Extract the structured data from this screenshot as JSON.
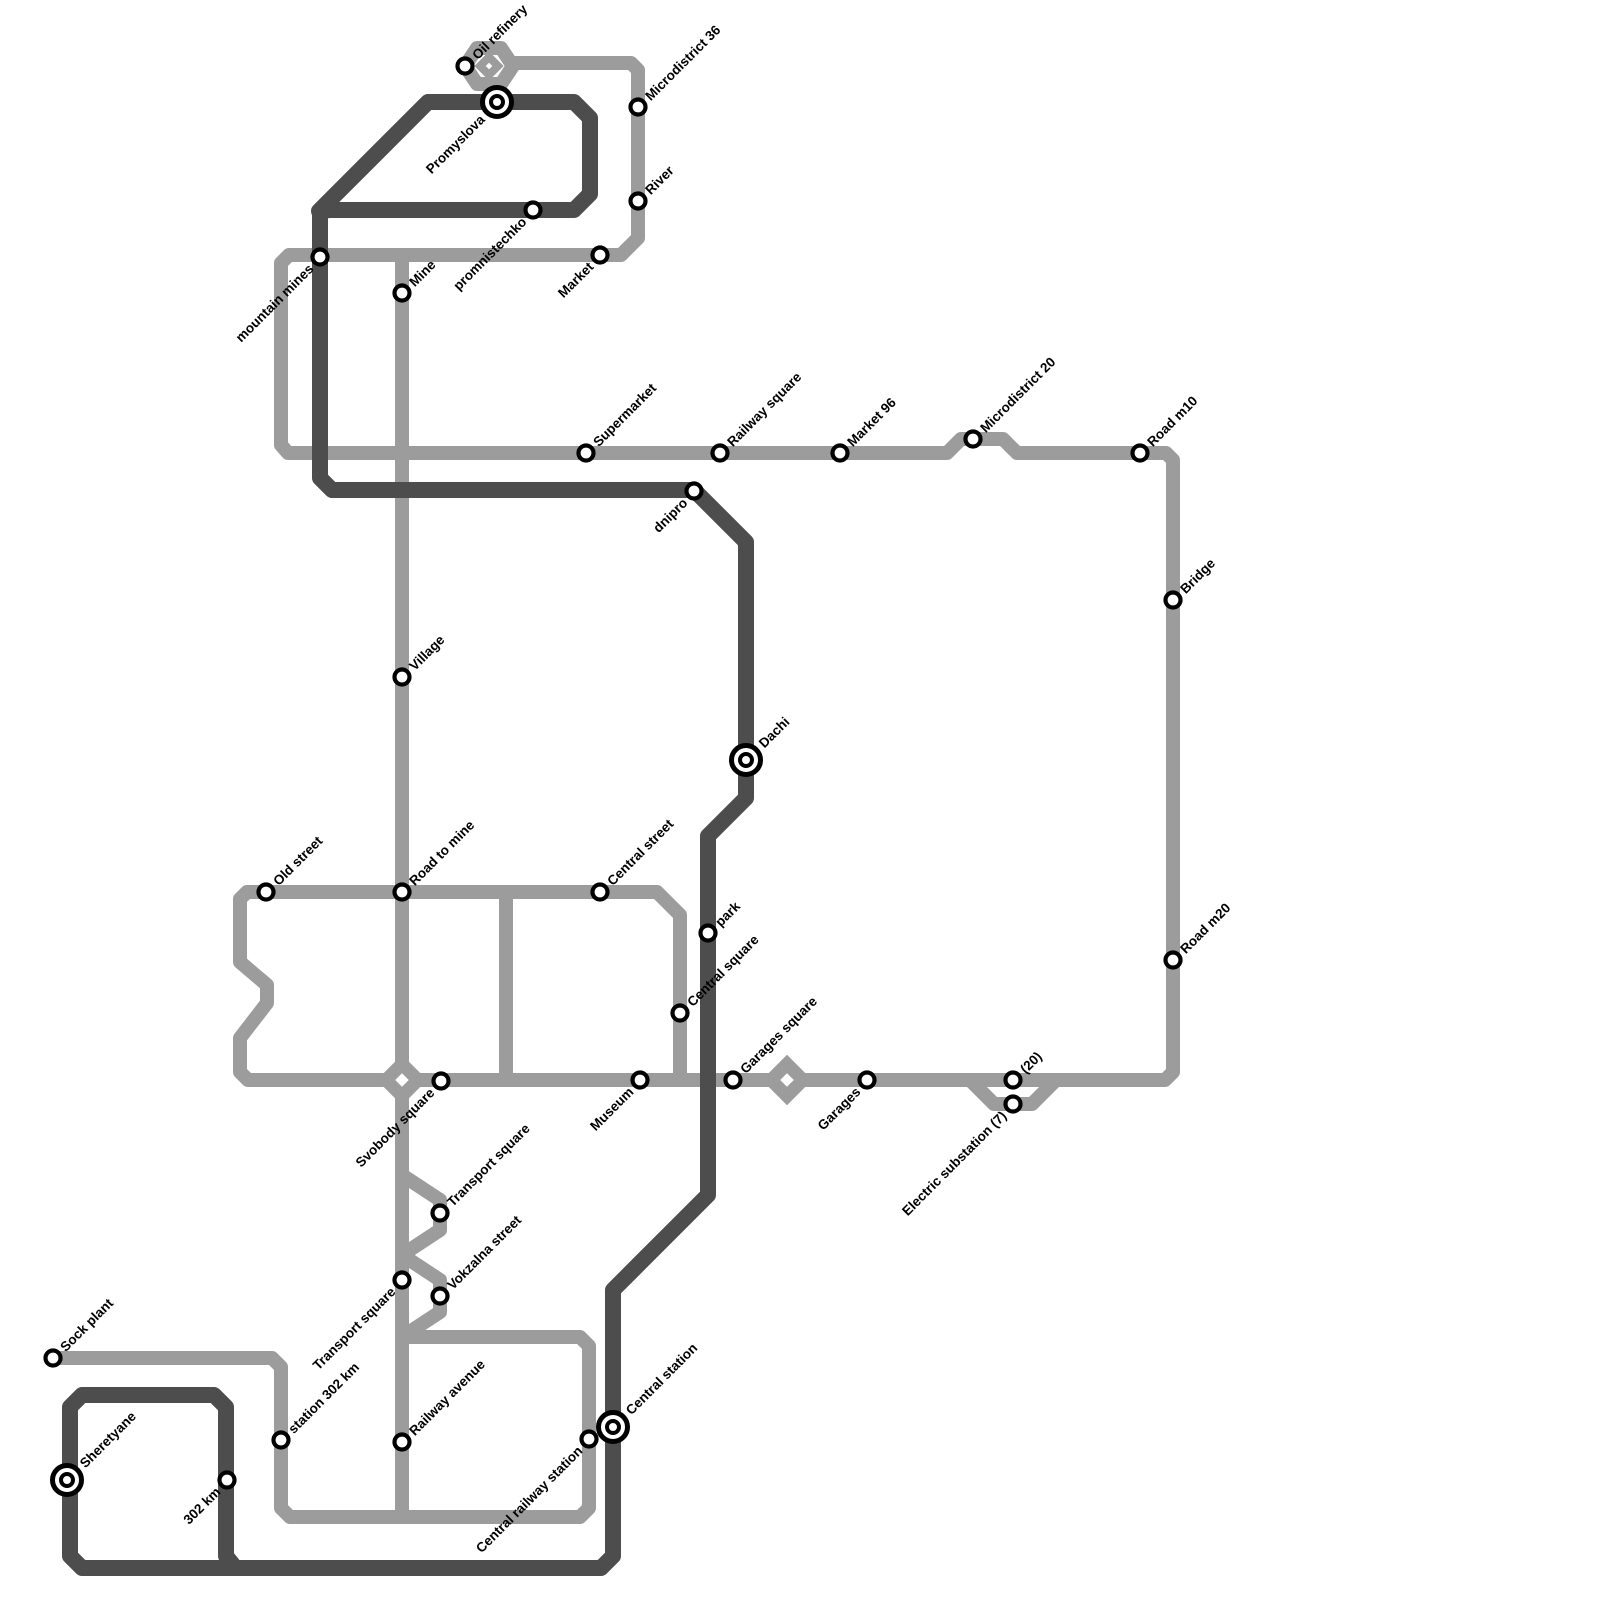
{
  "map": {
    "background": "#ffffff",
    "line_colors": {
      "light": "#9c9c9c",
      "dark": "#4d4d4d"
    },
    "routes": [
      {
        "id": "light-route",
        "color": "#9c9c9c",
        "width": 14,
        "paths": [
          {
            "closed": false,
            "points": [
              [
                515,
                63
              ],
              [
                631,
                63
              ],
              [
                638,
                70
              ],
              [
                638,
                238
              ],
              [
                621,
                255
              ],
              [
                289,
                255
              ],
              [
                281,
                263
              ],
              [
                281,
                445
              ],
              [
                288,
                453
              ],
              [
                947,
                453
              ],
              [
                961,
                439
              ],
              [
                1003,
                439
              ],
              [
                1017,
                453
              ],
              [
                1166,
                453
              ],
              [
                1173,
                460
              ],
              [
                1173,
                1072
              ],
              [
                1165,
                1080
              ],
              [
                248,
                1080
              ],
              [
                240,
                1072
              ],
              [
                240,
                1038
              ],
              [
                267,
                1003
              ],
              [
                267,
                985
              ],
              [
                240,
                962
              ],
              [
                240,
                899
              ],
              [
                247,
                892
              ],
              [
                657,
                892
              ],
              [
                680,
                915
              ],
              [
                680,
                1080
              ]
            ]
          },
          {
            "closed": false,
            "points": [
              [
                506,
                892
              ],
              [
                506,
                1080
              ]
            ]
          },
          {
            "closed": false,
            "points": [
              [
                402,
                255
              ],
              [
                402,
                1337
              ]
            ]
          },
          {
            "closed": false,
            "points": [
              [
                402,
                1175
              ],
              [
                440,
                1200
              ],
              [
                440,
                1230
              ],
              [
                402,
                1255
              ]
            ]
          },
          {
            "closed": false,
            "points": [
              [
                402,
                1255
              ],
              [
                440,
                1280
              ],
              [
                440,
                1312
              ],
              [
                402,
                1337
              ]
            ]
          },
          {
            "closed": false,
            "points": [
              [
                970,
                1080
              ],
              [
                994,
                1104
              ],
              [
                1032,
                1104
              ],
              [
                1056,
                1080
              ]
            ]
          },
          {
            "closed": false,
            "points": [
              [
                53,
                1358
              ],
              [
                272,
                1358
              ],
              [
                281,
                1367
              ],
              [
                281,
                1508
              ],
              [
                290,
                1517
              ],
              [
                402,
                1517
              ]
            ]
          },
          {
            "closed": true,
            "points": [
              [
                402,
                1517
              ],
              [
                402,
                1337
              ],
              [
                410,
                1337
              ],
              [
                580,
                1337
              ],
              [
                589,
                1346
              ],
              [
                589,
                1508
              ],
              [
                580,
                1517
              ]
            ]
          },
          {
            "closed": true,
            "points": [
              [
                465,
                66
              ],
              [
                477,
                48
              ],
              [
                501,
                48
              ],
              [
                513,
                66
              ],
              [
                501,
                84
              ],
              [
                477,
                84
              ]
            ]
          }
        ]
      },
      {
        "id": "dark-route",
        "color": "#4d4d4d",
        "width": 16,
        "paths": [
          {
            "closed": true,
            "points": [
              [
                319,
                211
              ],
              [
                428,
                102
              ],
              [
                574,
                102
              ],
              [
                590,
                118
              ],
              [
                590,
                194
              ],
              [
                574,
                210
              ],
              [
                330,
                210
              ]
            ]
          },
          {
            "closed": false,
            "points": [
              [
                320,
                212
              ],
              [
                320,
                478
              ],
              [
                332,
                490
              ],
              [
                694,
                490
              ],
              [
                746,
                542
              ],
              [
                746,
                798
              ],
              [
                708,
                836
              ],
              [
                708,
                1195
              ],
              [
                613,
                1290
              ],
              [
                613,
                1556
              ],
              [
                601,
                1568
              ],
              [
                82,
                1568
              ],
              [
                70,
                1556
              ],
              [
                70,
                1407
              ],
              [
                82,
                1395
              ],
              [
                214,
                1395
              ],
              [
                226,
                1407
              ],
              [
                226,
                1556
              ],
              [
                234,
                1566
              ]
            ]
          }
        ]
      }
    ],
    "depot_diamonds": [
      {
        "name": "oil-refinery-depot",
        "x": 489,
        "y": 66,
        "r": 9,
        "stroke": 8,
        "route": "light"
      },
      {
        "name": "svobody-square-depot",
        "x": 402,
        "y": 1080,
        "r": 16,
        "stroke": 13,
        "route": "light"
      },
      {
        "name": "garages-square-depot",
        "x": 787,
        "y": 1080,
        "r": 16,
        "stroke": 13,
        "route": "light"
      }
    ],
    "stations": [
      {
        "name": "Oil refinery",
        "x": 465,
        "y": 66,
        "kind": "regular",
        "label_dir": "ne",
        "route": "light"
      },
      {
        "name": "Microdistrict 36",
        "x": 638,
        "y": 107,
        "kind": "regular",
        "label_dir": "ne",
        "route": "light"
      },
      {
        "name": "River",
        "x": 638,
        "y": 201,
        "kind": "regular",
        "label_dir": "ne",
        "route": "light"
      },
      {
        "name": "Market",
        "x": 600,
        "y": 255,
        "kind": "regular",
        "label_dir": "sw",
        "route": "light"
      },
      {
        "name": "mountain mines",
        "x": 320,
        "y": 257,
        "kind": "regular",
        "label_dir": "sw",
        "route": "light"
      },
      {
        "name": "Mine",
        "x": 402,
        "y": 293,
        "kind": "regular",
        "label_dir": "ne",
        "route": "light"
      },
      {
        "name": "Village",
        "x": 402,
        "y": 677,
        "kind": "regular",
        "label_dir": "ne",
        "route": "light"
      },
      {
        "name": "Supermarket",
        "x": 586,
        "y": 453,
        "kind": "regular",
        "label_dir": "ne",
        "route": "light"
      },
      {
        "name": "Railway square",
        "x": 720,
        "y": 453,
        "kind": "regular",
        "label_dir": "ne",
        "route": "light"
      },
      {
        "name": "Market 96",
        "x": 840,
        "y": 453,
        "kind": "regular",
        "label_dir": "ne",
        "route": "light"
      },
      {
        "name": "Microdistrict 20",
        "x": 973,
        "y": 439,
        "kind": "regular",
        "label_dir": "ne",
        "route": "light"
      },
      {
        "name": "Road m10",
        "x": 1140,
        "y": 453,
        "kind": "regular",
        "label_dir": "ne",
        "route": "light"
      },
      {
        "name": "Bridge",
        "x": 1173,
        "y": 600,
        "kind": "regular",
        "label_dir": "ne",
        "route": "light"
      },
      {
        "name": "Road m20",
        "x": 1173,
        "y": 960,
        "kind": "regular",
        "label_dir": "ne",
        "route": "light"
      },
      {
        "name": "Old street",
        "x": 266,
        "y": 892,
        "kind": "regular",
        "label_dir": "ne",
        "route": "light"
      },
      {
        "name": "Road to mine",
        "x": 402,
        "y": 892,
        "kind": "regular",
        "label_dir": "ne",
        "route": "light"
      },
      {
        "name": "Central street",
        "x": 600,
        "y": 892,
        "kind": "regular",
        "label_dir": "ne",
        "route": "light"
      },
      {
        "name": "Central square",
        "x": 680,
        "y": 1013,
        "kind": "regular",
        "label_dir": "ne",
        "route": "light"
      },
      {
        "name": "Svobody square",
        "x": 441,
        "y": 1081,
        "kind": "regular",
        "label_dir": "sw",
        "route": "light"
      },
      {
        "name": "Museum",
        "x": 640,
        "y": 1080,
        "kind": "regular",
        "label_dir": "sw",
        "route": "light"
      },
      {
        "name": "Garages square",
        "x": 733,
        "y": 1080,
        "kind": "regular",
        "label_dir": "ne",
        "route": "light"
      },
      {
        "name": "Garages",
        "x": 867,
        "y": 1080,
        "kind": "regular",
        "label_dir": "sw",
        "route": "light"
      },
      {
        "name": "(20)",
        "x": 1013,
        "y": 1080,
        "kind": "regular",
        "label_dir": "ne",
        "route": "light"
      },
      {
        "name": "Electric substation (7)",
        "x": 1013,
        "y": 1104,
        "kind": "regular",
        "label_dir": "sw",
        "route": "light"
      },
      {
        "name": "Transport square",
        "x": 440,
        "y": 1213,
        "kind": "regular",
        "label_dir": "ne",
        "route": "light"
      },
      {
        "name": "Transport square",
        "x": 402,
        "y": 1280,
        "kind": "regular",
        "label_dir": "sw",
        "route": "light"
      },
      {
        "name": "Vokzalna street",
        "x": 440,
        "y": 1296,
        "kind": "regular",
        "label_dir": "ne",
        "route": "light"
      },
      {
        "name": "Railway avenue",
        "x": 402,
        "y": 1442,
        "kind": "regular",
        "label_dir": "ne",
        "route": "light"
      },
      {
        "name": "Central railway station",
        "x": 589,
        "y": 1439,
        "kind": "regular",
        "label_dir": "sw",
        "route": "light"
      },
      {
        "name": "Sock plant",
        "x": 53,
        "y": 1358,
        "kind": "regular",
        "label_dir": "ne",
        "route": "light"
      },
      {
        "name": "station 302 km",
        "x": 281,
        "y": 1440,
        "kind": "regular",
        "label_dir": "ne",
        "route": "light"
      },
      {
        "name": "Promyslova",
        "x": 497,
        "y": 102,
        "kind": "terminal",
        "label_dir": "sw",
        "route": "dark"
      },
      {
        "name": "promnistechko",
        "x": 533,
        "y": 210,
        "kind": "regular",
        "label_dir": "sw",
        "route": "dark"
      },
      {
        "name": "dnipro",
        "x": 694,
        "y": 491,
        "kind": "regular",
        "label_dir": "sw",
        "route": "dark"
      },
      {
        "name": "Dachi",
        "x": 746,
        "y": 760,
        "kind": "terminal",
        "label_dir": "ne",
        "route": "dark"
      },
      {
        "name": "park",
        "x": 708,
        "y": 933,
        "kind": "regular",
        "label_dir": "ne",
        "route": "dark"
      },
      {
        "name": "Central station",
        "x": 613,
        "y": 1427,
        "kind": "terminal",
        "label_dir": "ne",
        "route": "dark"
      },
      {
        "name": "Sheretyane",
        "x": 67,
        "y": 1480,
        "kind": "terminal",
        "label_dir": "ne",
        "route": "dark"
      },
      {
        "name": "302 km",
        "x": 227,
        "y": 1480,
        "kind": "regular",
        "label_dir": "sw",
        "route": "dark"
      }
    ],
    "marker_style": {
      "regular": {
        "radius": 7.5,
        "ring": 4.2
      },
      "terminal": {
        "outer_radius": 14.5,
        "outer_ring": 5,
        "inner_radius": 6,
        "inner_ring": 4
      },
      "ring_color": "#000000",
      "fill_color": "#ffffff"
    },
    "label_style": {
      "rotation_deg": -45,
      "font_size": 13.5,
      "offset_regular": 13,
      "offset_terminal": 21
    }
  }
}
